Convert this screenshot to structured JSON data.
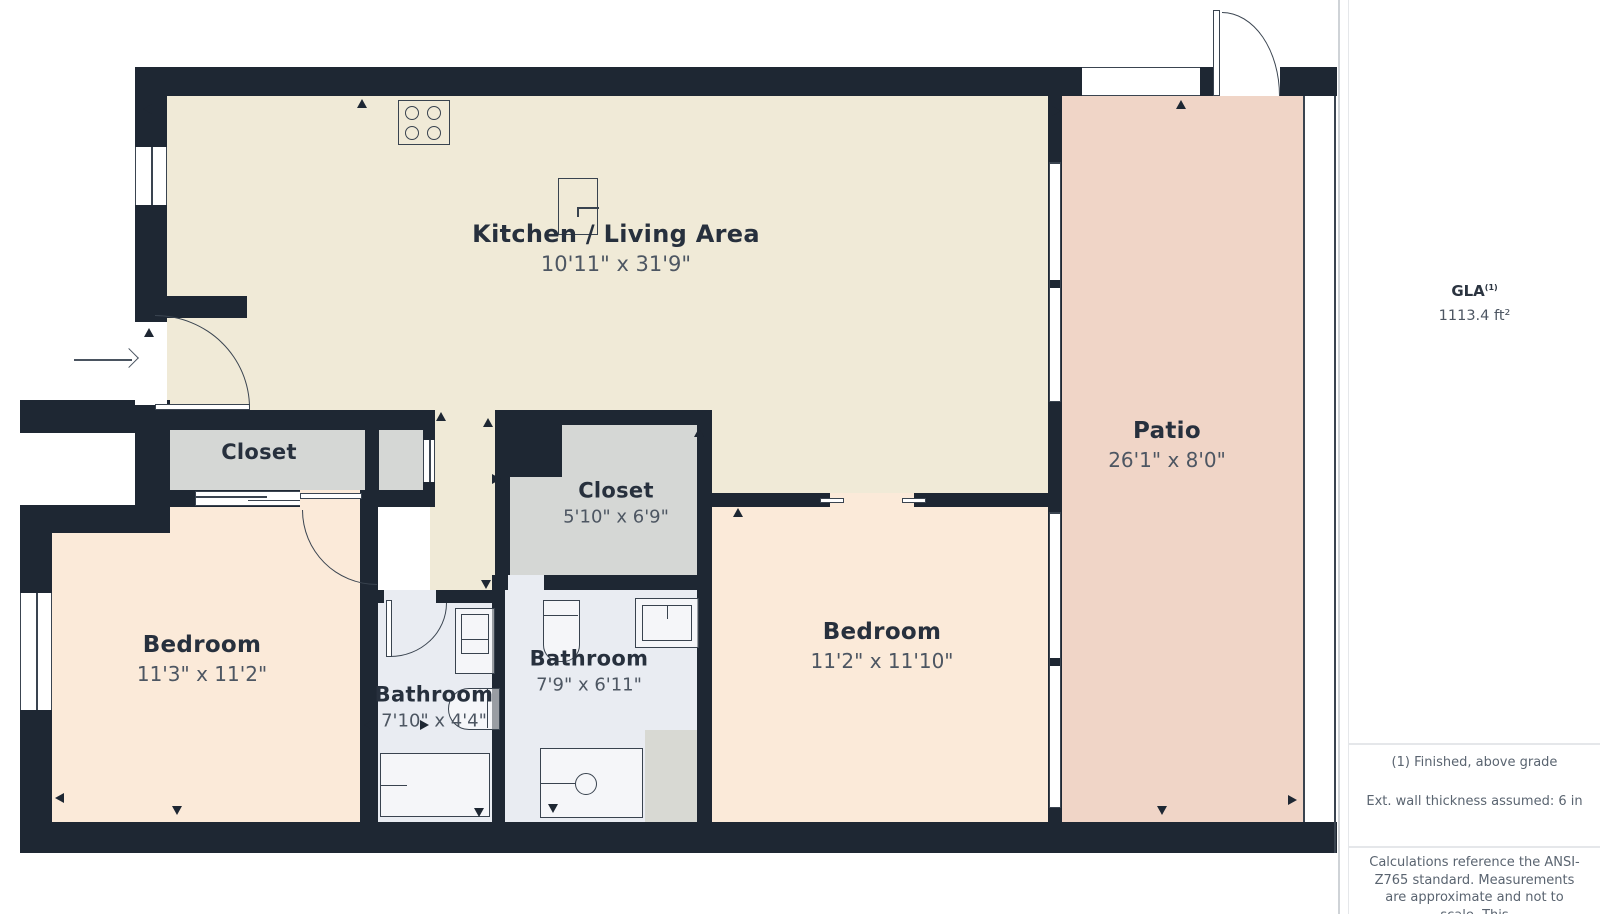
{
  "rooms": {
    "kitchen_living": {
      "name": "Kitchen / Living Area",
      "dims": "10'11\" x 31'9\""
    },
    "closet_left": {
      "name": "Closet"
    },
    "closet_mid": {
      "name": "Closet",
      "dims": "5'10\" x 6'9\""
    },
    "bedroom_left": {
      "name": "Bedroom",
      "dims": "11'3\" x 11'2\""
    },
    "bedroom_right": {
      "name": "Bedroom",
      "dims": "11'2\" x 11'10\""
    },
    "bathroom_left": {
      "name": "Bathroom",
      "dims": "7'10\" x 4'4\""
    },
    "bathroom_mid": {
      "name": "Bathroom",
      "dims": "7'9\" x 6'11\""
    },
    "patio": {
      "name": "Patio",
      "dims": "26'1\" x 8'0\""
    }
  },
  "sidebar": {
    "gla_label": "GLA",
    "gla_superscript": "(1)",
    "gla_value": "1113.4 ft²",
    "note_finished": "(1) Finished, above grade",
    "note_wall": "Ext. wall thickness assumed: 6 in",
    "note_calc": "Calculations reference the ANSI-Z765 standard. Measurements are approximate and not to scale. This"
  },
  "colors": {
    "wall": "#1e2733",
    "living_fill": "#f0ead7",
    "bedroom_fill": "#fbead9",
    "patio_fill": "#f0d5c7",
    "closet_fill": "#d5d7d5",
    "bathroom_fill": "#e9ecf2",
    "utility_fill": "#d8d9d3"
  }
}
